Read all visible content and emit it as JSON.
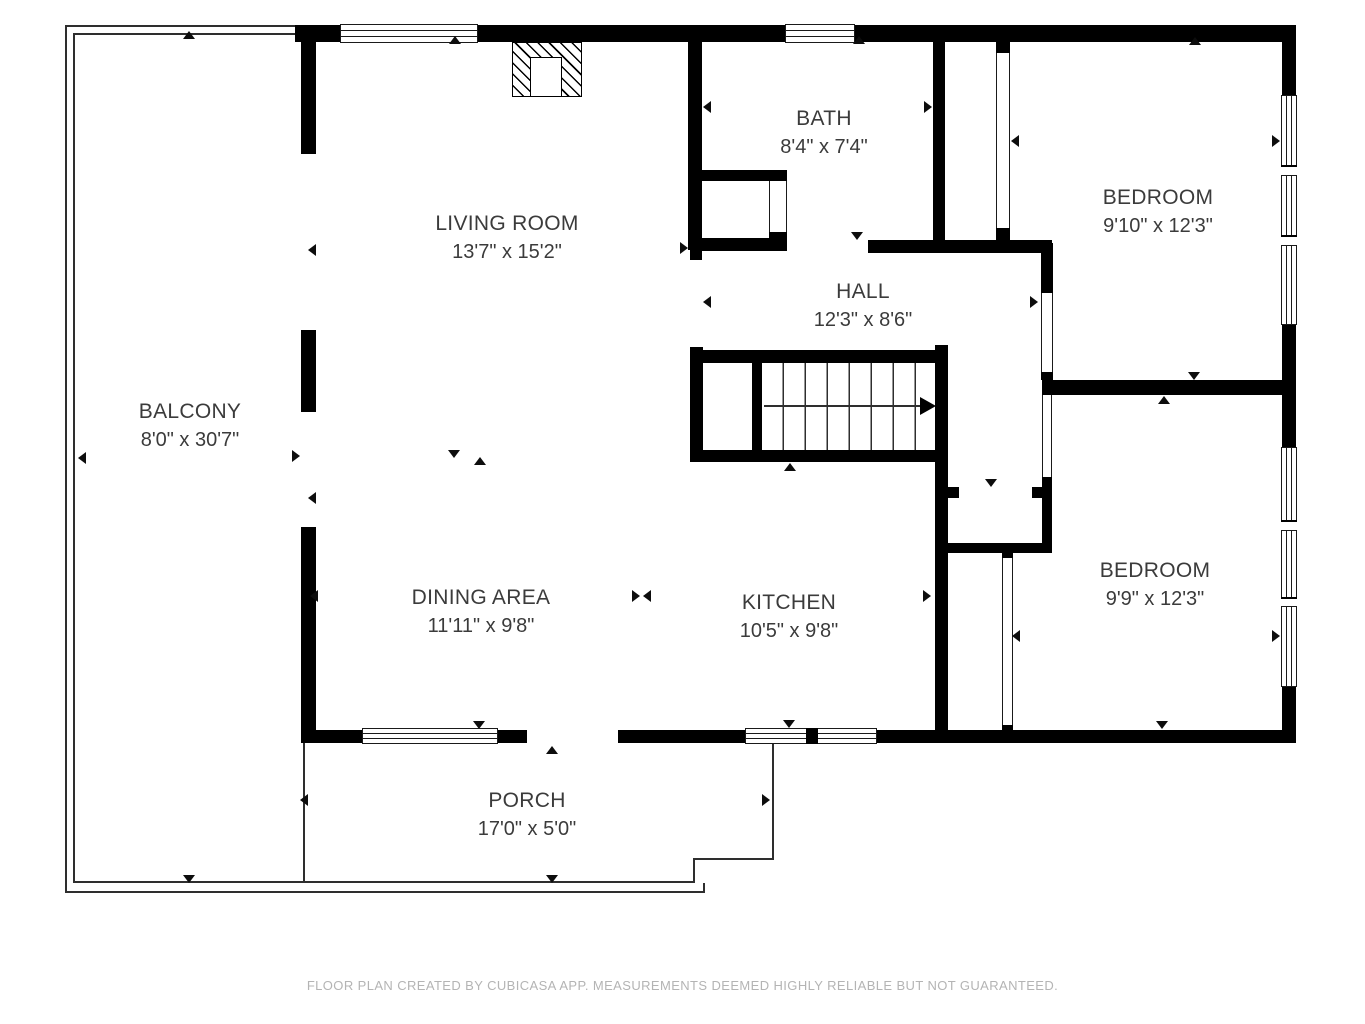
{
  "meta": {
    "app": "CubiCasa floor plan",
    "colors": {
      "wall": "#000000",
      "label_text": "#3b3b3b",
      "footer_text": "#b4b4b4",
      "background": "#ffffff"
    }
  },
  "rooms": [
    {
      "id": "balcony",
      "name": "BALCONY",
      "dims": "8'0\" x 30'7\""
    },
    {
      "id": "living-room",
      "name": "LIVING ROOM",
      "dims": "13'7\" x 15'2\""
    },
    {
      "id": "bath",
      "name": "BATH",
      "dims": "8'4\" x 7'4\""
    },
    {
      "id": "bedroom-top",
      "name": "BEDROOM",
      "dims": "9'10\" x 12'3\""
    },
    {
      "id": "hall",
      "name": "HALL",
      "dims": "12'3\" x 8'6\""
    },
    {
      "id": "dining-area",
      "name": "DINING AREA",
      "dims": "11'11\" x 9'8\""
    },
    {
      "id": "kitchen",
      "name": "KITCHEN",
      "dims": "10'5\" x 9'8\""
    },
    {
      "id": "bedroom-bottom",
      "name": "BEDROOM",
      "dims": "9'9\" x 12'3\""
    },
    {
      "id": "porch",
      "name": "PORCH",
      "dims": "17'0\" x 5'0\""
    }
  ],
  "footer": {
    "text": "FLOOR PLAN CREATED BY CUBICASA APP. MEASUREMENTS DEEMED HIGHLY RELIABLE BUT NOT GUARANTEED."
  }
}
